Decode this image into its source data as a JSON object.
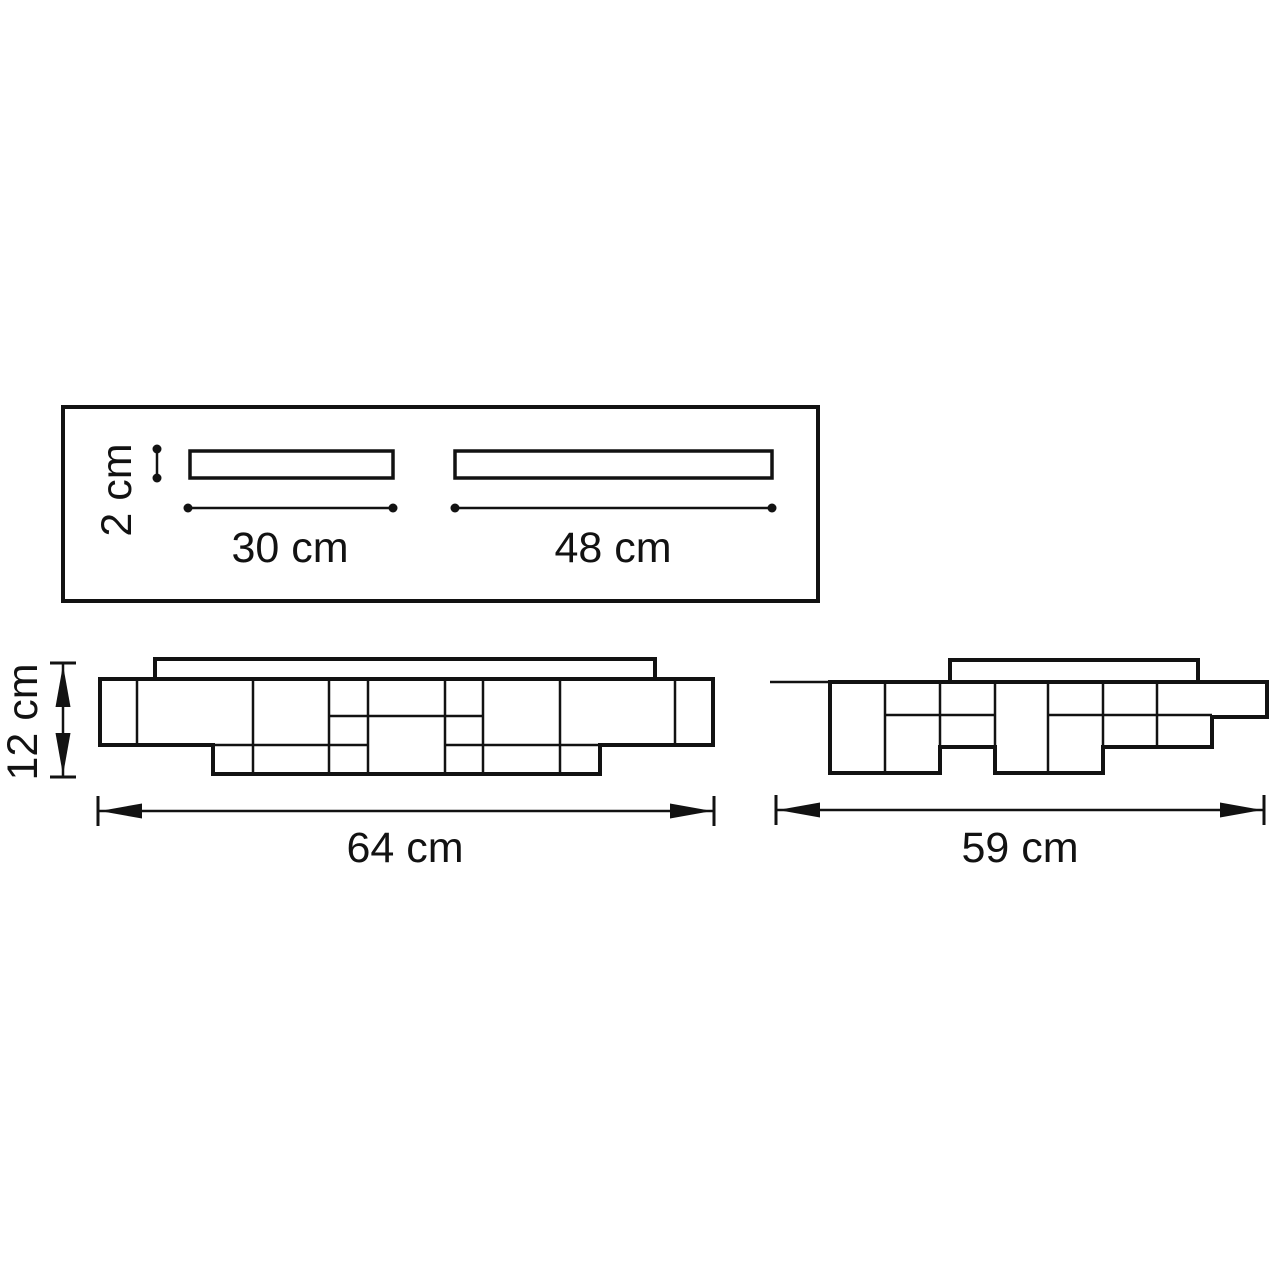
{
  "colors": {
    "ink": "#121212",
    "background": "#ffffff"
  },
  "labels": {
    "plate_thickness": "2 cm",
    "small_plate_length": "30 cm",
    "large_plate_length": "48 cm",
    "fixture_height": "12 cm",
    "front_width": "64 cm",
    "side_width": "59 cm"
  },
  "geometry": {
    "plan": [
      {
        "t": "rect",
        "name": "plan-outline",
        "x": 63,
        "y": 407,
        "w": 755,
        "h": 194,
        "sw": 4
      },
      {
        "t": "rect",
        "name": "plan-bar-30cm",
        "x": 190,
        "y": 451,
        "w": 203,
        "h": 27,
        "sw": 3.5
      },
      {
        "t": "rect",
        "name": "plan-bar-48cm",
        "x": 455,
        "y": 451,
        "w": 317,
        "h": 27,
        "sw": 3.5
      },
      {
        "t": "dotline",
        "name": "dim-2cm-line",
        "x1": 157,
        "y1": 449,
        "x2": 157,
        "y2": 478
      },
      {
        "t": "dotline",
        "name": "dim-30cm-line",
        "x1": 188,
        "y1": 508,
        "x2": 393,
        "y2": 508
      },
      {
        "t": "dotline",
        "name": "dim-48cm-line",
        "x1": 455,
        "y1": 508,
        "x2": 772,
        "y2": 508
      }
    ],
    "front": [
      {
        "t": "rect",
        "name": "front-canopy",
        "x": 155,
        "y": 659,
        "w": 500,
        "h": 20,
        "sw": 4
      },
      {
        "t": "path",
        "name": "front-body-outline",
        "d": "M 100,679 H 713 V 745 H 600 V 774 H 213 V 745 H 100 Z",
        "sw": 4
      },
      {
        "t": "line",
        "name": "front-grid-line",
        "x1": 137,
        "y1": 679,
        "x2": 137,
        "y2": 745,
        "sw": 2.5
      },
      {
        "t": "line",
        "name": "front-grid-line",
        "x1": 253,
        "y1": 679,
        "x2": 253,
        "y2": 774,
        "sw": 2.5
      },
      {
        "t": "line",
        "name": "front-grid-line",
        "x1": 329,
        "y1": 679,
        "x2": 329,
        "y2": 774,
        "sw": 2.5
      },
      {
        "t": "line",
        "name": "front-grid-line",
        "x1": 368,
        "y1": 679,
        "x2": 368,
        "y2": 774,
        "sw": 2.5
      },
      {
        "t": "line",
        "name": "front-grid-line",
        "x1": 445,
        "y1": 679,
        "x2": 445,
        "y2": 774,
        "sw": 2.5
      },
      {
        "t": "line",
        "name": "front-grid-line",
        "x1": 483,
        "y1": 679,
        "x2": 483,
        "y2": 774,
        "sw": 2.5
      },
      {
        "t": "line",
        "name": "front-grid-line",
        "x1": 560,
        "y1": 679,
        "x2": 560,
        "y2": 774,
        "sw": 2.5
      },
      {
        "t": "line",
        "name": "front-grid-line",
        "x1": 675,
        "y1": 679,
        "x2": 675,
        "y2": 745,
        "sw": 2.5
      },
      {
        "t": "line",
        "name": "front-grid-line",
        "x1": 329,
        "y1": 716,
        "x2": 483,
        "y2": 716,
        "sw": 2.5
      },
      {
        "t": "line",
        "name": "front-grid-line",
        "x1": 213,
        "y1": 745,
        "x2": 368,
        "y2": 745,
        "sw": 2.5
      },
      {
        "t": "line",
        "name": "front-grid-line",
        "x1": 445,
        "y1": 745,
        "x2": 600,
        "y2": 745,
        "sw": 2.5
      },
      {
        "t": "dimv",
        "name": "dim-12cm-arrow",
        "x": 63,
        "y1": 663,
        "y2": 777
      },
      {
        "t": "dimh",
        "name": "dim-64cm-arrow",
        "x1": 98,
        "x2": 714,
        "y": 811
      }
    ],
    "side": [
      {
        "t": "line",
        "name": "side-ceiling-line",
        "x1": 770,
        "y1": 682,
        "x2": 830,
        "y2": 682,
        "sw": 2.5
      },
      {
        "t": "rect",
        "name": "side-canopy",
        "x": 950,
        "y": 660,
        "w": 248,
        "h": 22,
        "sw": 4
      },
      {
        "t": "path",
        "name": "side-body-outline",
        "d": "M 830,682 H 1267 V 717 H 1212 V 747 H 1103 V 773 H 995 V 747 H 940 V 773 H 830 Z",
        "sw": 4
      },
      {
        "t": "line",
        "name": "side-grid-line",
        "x1": 885,
        "y1": 682,
        "x2": 885,
        "y2": 773,
        "sw": 2.5
      },
      {
        "t": "line",
        "name": "side-grid-line",
        "x1": 940,
        "y1": 682,
        "x2": 940,
        "y2": 773,
        "sw": 2.5
      },
      {
        "t": "line",
        "name": "side-grid-line",
        "x1": 995,
        "y1": 682,
        "x2": 995,
        "y2": 773,
        "sw": 2.5
      },
      {
        "t": "line",
        "name": "side-grid-line",
        "x1": 1048,
        "y1": 682,
        "x2": 1048,
        "y2": 773,
        "sw": 2.5
      },
      {
        "t": "line",
        "name": "side-grid-line",
        "x1": 1103,
        "y1": 682,
        "x2": 1103,
        "y2": 773,
        "sw": 2.5
      },
      {
        "t": "line",
        "name": "side-grid-line",
        "x1": 1157,
        "y1": 682,
        "x2": 1157,
        "y2": 747,
        "sw": 2.5
      },
      {
        "t": "line",
        "name": "side-grid-line",
        "x1": 885,
        "y1": 715,
        "x2": 995,
        "y2": 715,
        "sw": 2.5
      },
      {
        "t": "line",
        "name": "side-grid-line",
        "x1": 1048,
        "y1": 715,
        "x2": 1212,
        "y2": 715,
        "sw": 2.5
      },
      {
        "t": "dimh",
        "name": "dim-59cm-arrow",
        "x1": 776,
        "x2": 1264,
        "y": 810
      }
    ]
  }
}
